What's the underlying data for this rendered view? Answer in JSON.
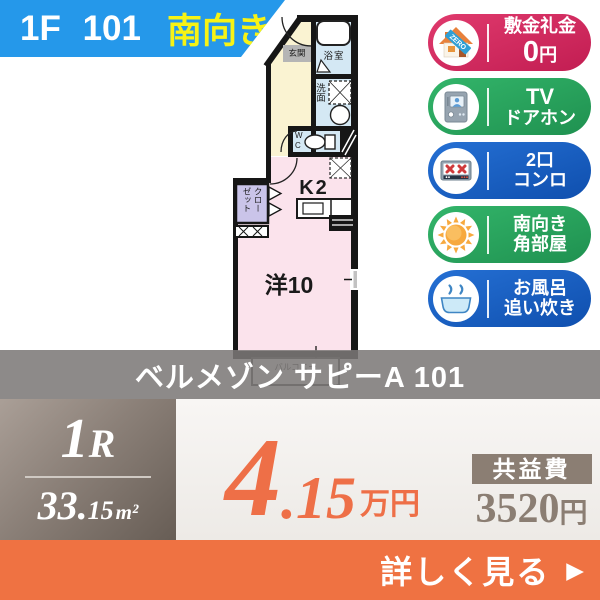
{
  "header": {
    "unit": "1F 101",
    "direction": "南向き"
  },
  "badges": [
    {
      "line1": "敷金礼金",
      "line2": "0円",
      "ribbon": "ZERO"
    },
    {
      "line1": "TV",
      "line2": "ドアホン"
    },
    {
      "line1": "2口",
      "line2": "コンロ"
    },
    {
      "line1": "南向き",
      "line2": "角部屋"
    },
    {
      "line1": "お風呂",
      "line2": "追い炊き"
    }
  ],
  "floorplan": {
    "genkan": "玄関",
    "bath": "浴室",
    "washroom": "洗面",
    "wc": "W\nC",
    "kitchen": "K2",
    "closet": "クローゼット",
    "main_room": "洋10",
    "balcony": "バルコニー"
  },
  "title": "ベルメゾン サピーA 101",
  "details": {
    "layout": "1R",
    "area_int": "33.",
    "area_frac": "15",
    "area_unit": "m²",
    "rent_int": "4",
    "rent_frac": ".15",
    "rent_unit": "万円",
    "fee_label": "共益費",
    "fee_value": "3520",
    "fee_unit": "円"
  },
  "footer": {
    "cta": "詳しく見る",
    "arrow": "▶"
  },
  "colors": {
    "banner_blue": "#2598ea",
    "direction_yellow": "#f7f315",
    "badge_pink": "#d5295e",
    "badge_green": "#2bab60",
    "badge_blue": "#1b63c5",
    "price_orange": "#ee6f47",
    "footer_orange": "#ef7242",
    "panel_brown": "#8b8078",
    "fee_brown": "#8b7e73"
  }
}
